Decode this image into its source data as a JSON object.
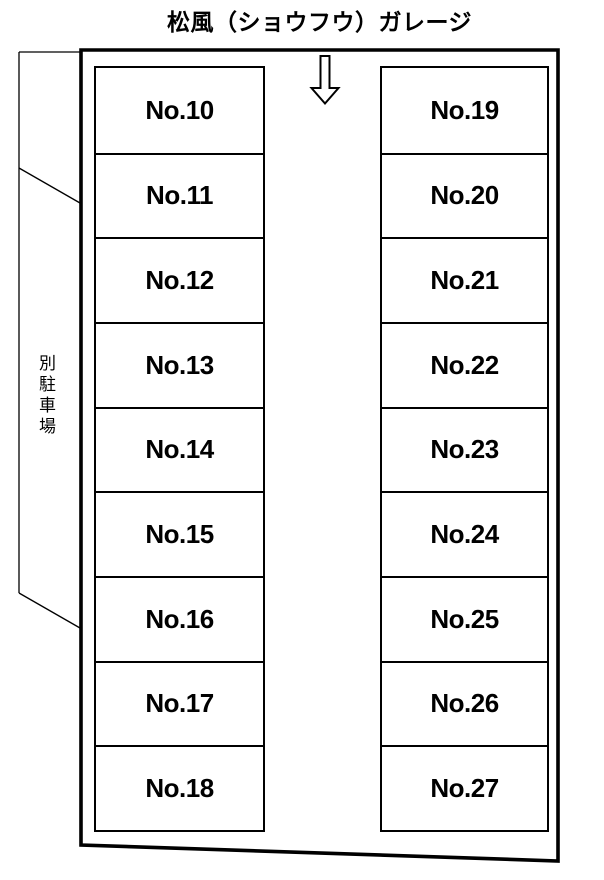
{
  "title": "松風（ショウフウ）ガレージ",
  "arrow": {
    "icon": "down-arrow",
    "meaning": "entrance direction"
  },
  "annex": {
    "label": "別駐車場"
  },
  "space_prefix": "No.",
  "left_column": {
    "numbers": [
      "10",
      "11",
      "12",
      "13",
      "14",
      "15",
      "16",
      "17",
      "18"
    ]
  },
  "right_column": {
    "numbers": [
      "19",
      "20",
      "21",
      "22",
      "23",
      "24",
      "25",
      "26",
      "27"
    ]
  },
  "colors": {
    "line": "#000000",
    "background": "#ffffff",
    "text": "#000000"
  }
}
